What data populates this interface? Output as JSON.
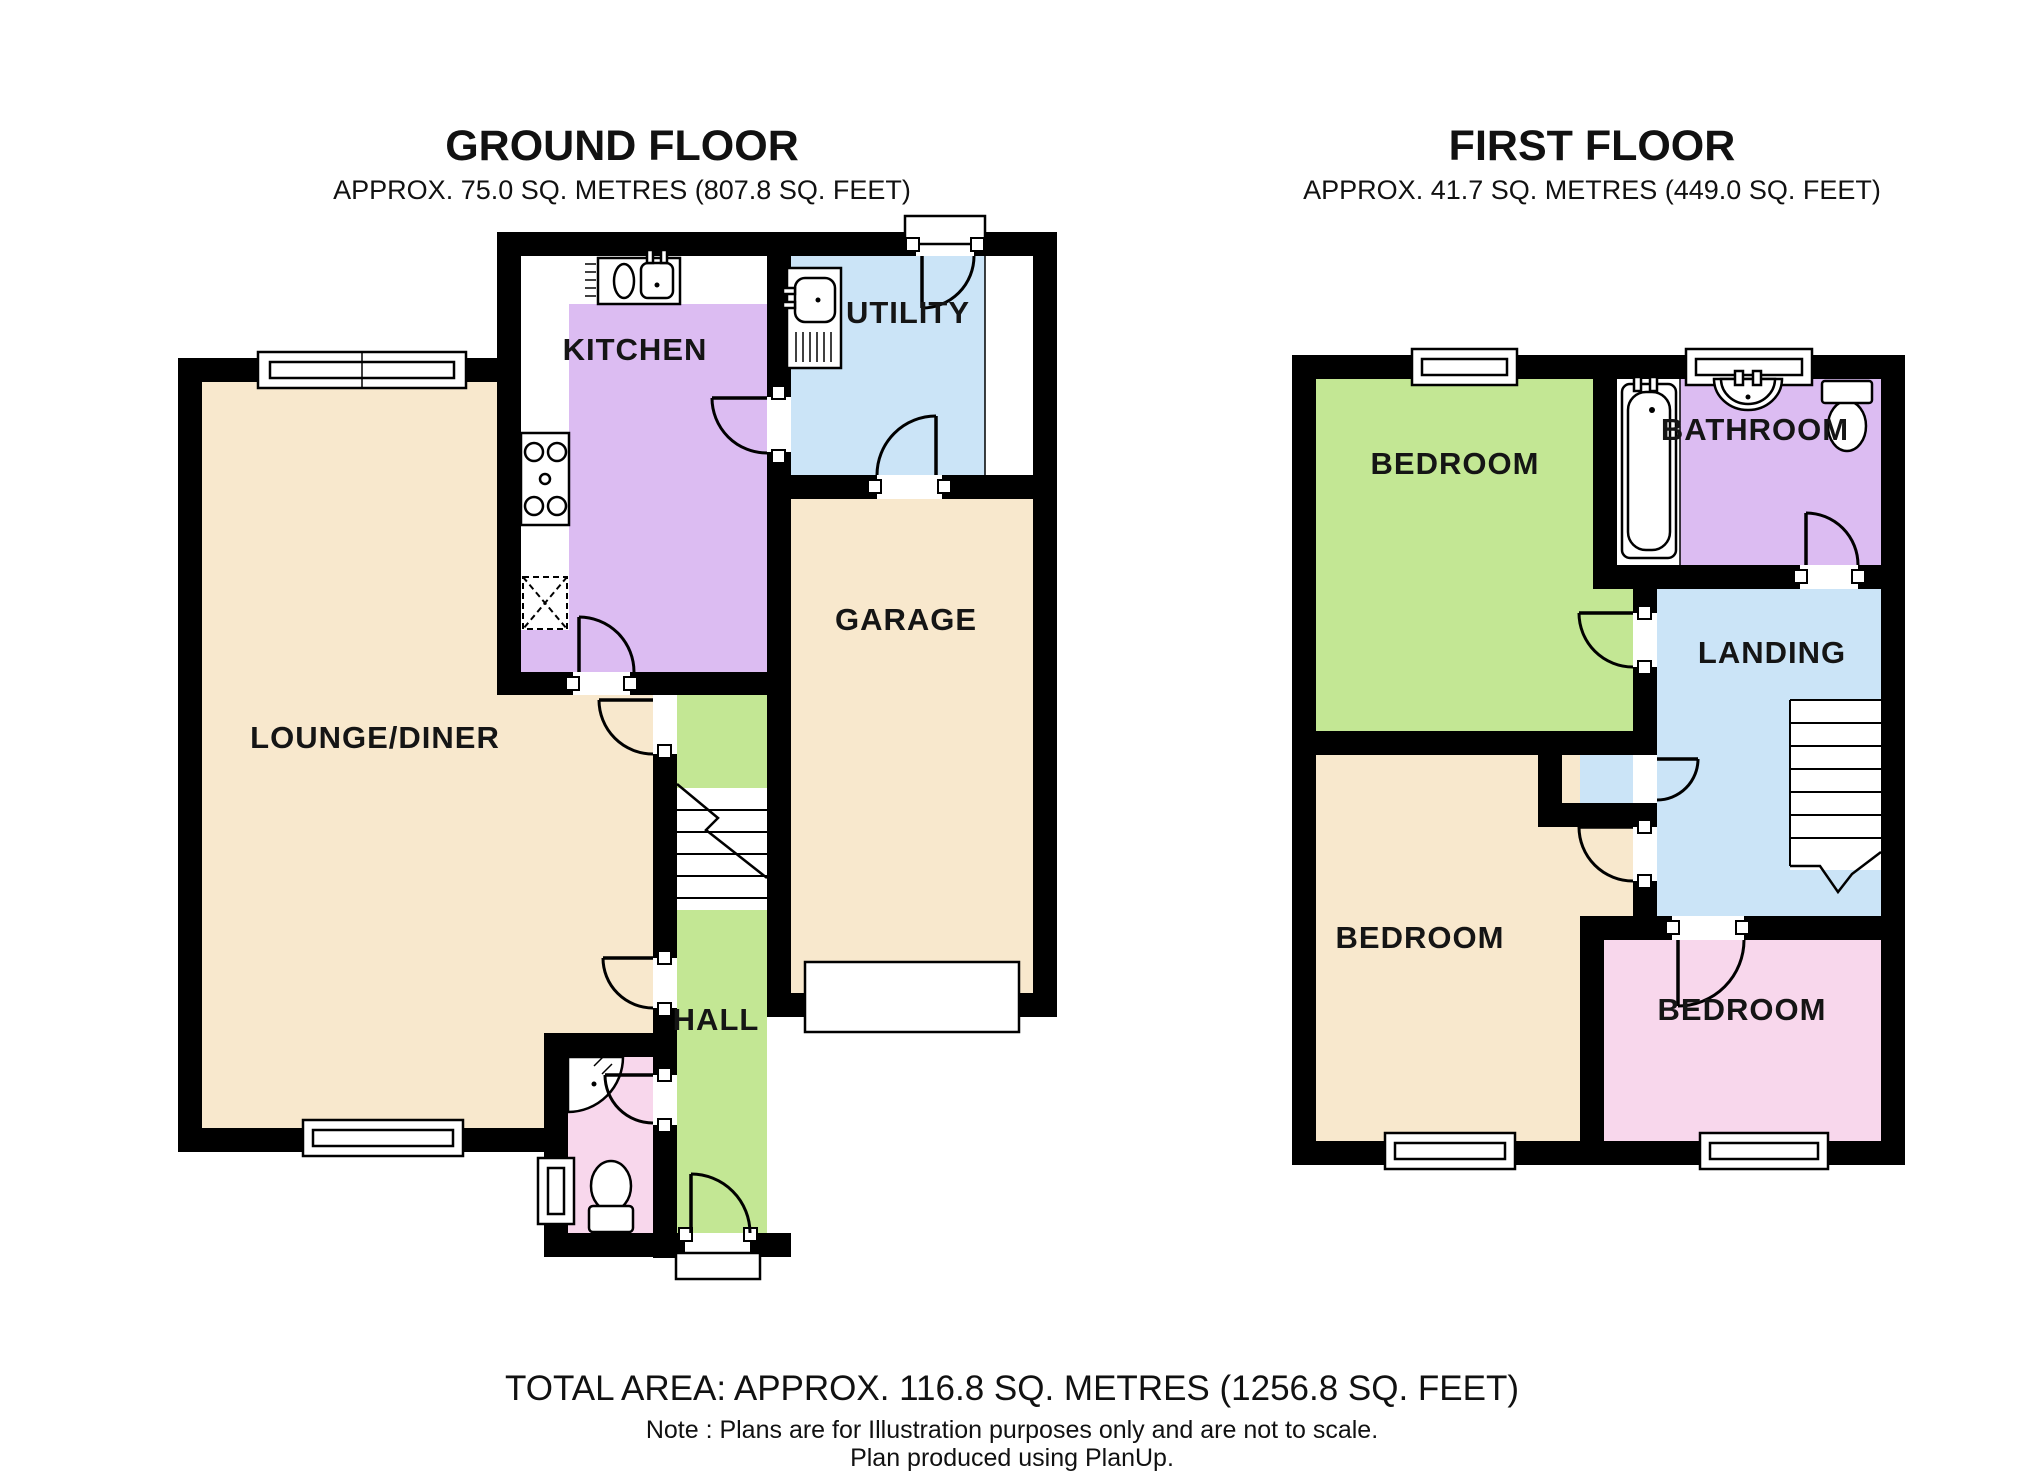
{
  "colors": {
    "wall": "#000000",
    "beige": "#f8e8cd",
    "purple": "#dcbcf2",
    "blue": "#cbe4f7",
    "green": "#c3e794",
    "pink": "#f8d7ec",
    "white": "#ffffff"
  },
  "ground": {
    "title": "GROUND FLOOR",
    "subtitle": "APPROX.  75.0 SQ. METRES (807.8 SQ. FEET)",
    "rooms": {
      "kitchen": "KITCHEN",
      "utility": "UTILITY",
      "garage": "GARAGE",
      "lounge_diner": "LOUNGE/DINER",
      "hall": "HALL"
    }
  },
  "first": {
    "title": "FIRST FLOOR",
    "subtitle": "APPROX.  41.7 SQ. METRES (449.0 SQ. FEET)",
    "rooms": {
      "bedroom_top": "BEDROOM",
      "bathroom": "BATHROOM",
      "landing": "LANDING",
      "bedroom_left": "BEDROOM",
      "bedroom_right": "BEDROOM"
    }
  },
  "footer": {
    "total_area": "TOTAL AREA: APPROX. 116.8 SQ. METRES (1256.8 SQ. FEET)",
    "note": "Note : Plans are for Illustration purposes only and are not to scale.",
    "produced": "Plan produced using PlanUp."
  }
}
